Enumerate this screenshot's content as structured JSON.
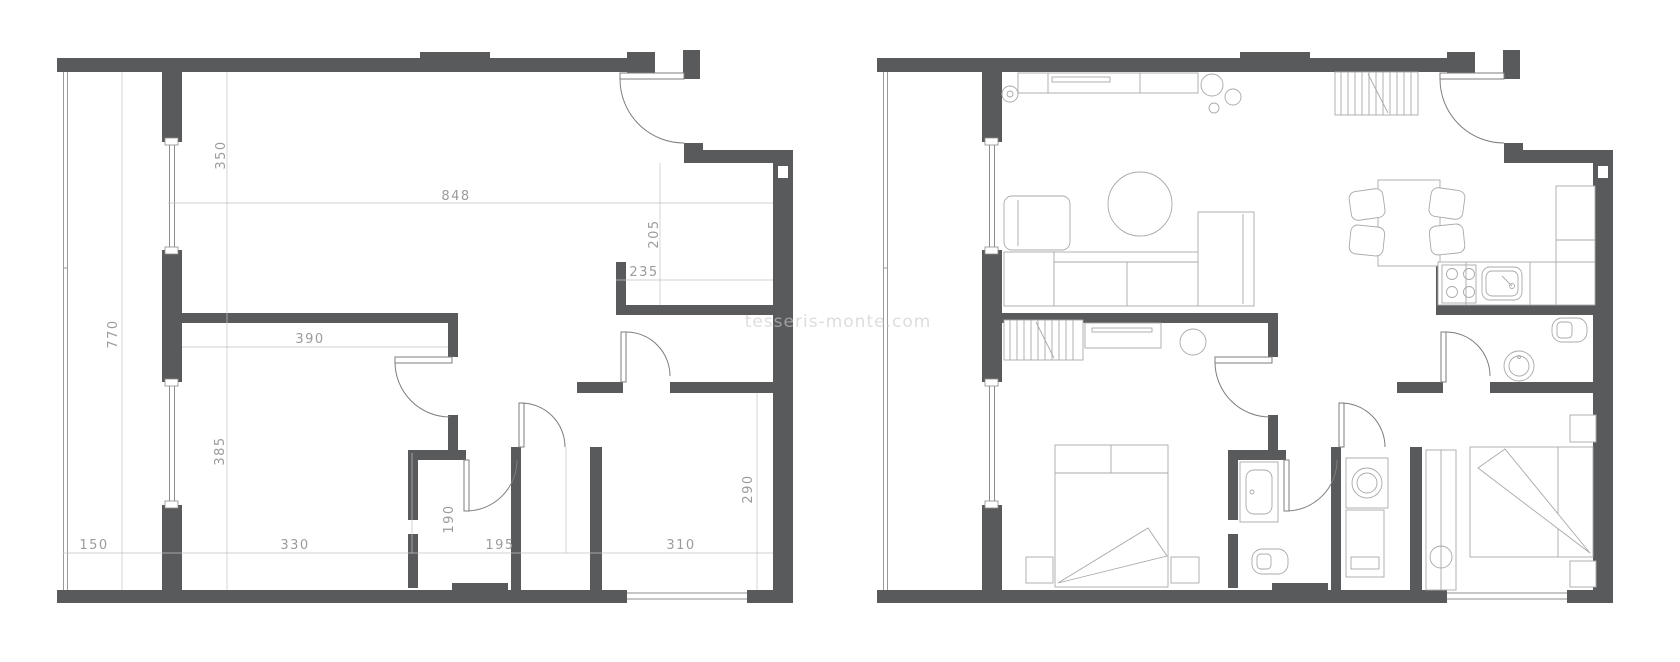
{
  "page": {
    "background": "#ffffff"
  },
  "colors": {
    "wall": "#595a5c",
    "window_line": "#8d8d8d",
    "railing_line": "#9a9a9a",
    "door_line": "#7d7d7d",
    "dimension_line": "#c2c2c2",
    "dimension_text": "#9b9b9b",
    "furniture_line": "#a9a9a9",
    "watermark_text": "#c9c9c9"
  },
  "watermark": {
    "text": "tesseris-monte.com"
  },
  "plans": {
    "left": {
      "name": "floor-plan-dimensioned",
      "dimensions": [
        {
          "label": "848"
        },
        {
          "label": "350"
        },
        {
          "label": "205"
        },
        {
          "label": "235"
        },
        {
          "label": "770"
        },
        {
          "label": "390"
        },
        {
          "label": "385"
        },
        {
          "label": "290"
        },
        {
          "label": "150"
        },
        {
          "label": "330"
        },
        {
          "label": "190"
        },
        {
          "label": "195"
        },
        {
          "label": "310"
        }
      ]
    },
    "right": {
      "name": "floor-plan-furnished",
      "fixtures": [
        "staircase-hall",
        "staircase-entry",
        "tv-sideboard",
        "floor-lamp",
        "plants",
        "rug",
        "armchair",
        "sofa",
        "chaise-longue",
        "side-table",
        "console-with-mirror",
        "double-bed-left",
        "double-bed-right",
        "nightstands",
        "bathroom-vanity",
        "toilet",
        "washing-machine",
        "utility-unit",
        "wardrobe",
        "dining-table",
        "dining-chairs",
        "cooktop",
        "kitchen-sink",
        "refrigerator",
        "wc-toilet",
        "wc-washbasin"
      ]
    }
  }
}
